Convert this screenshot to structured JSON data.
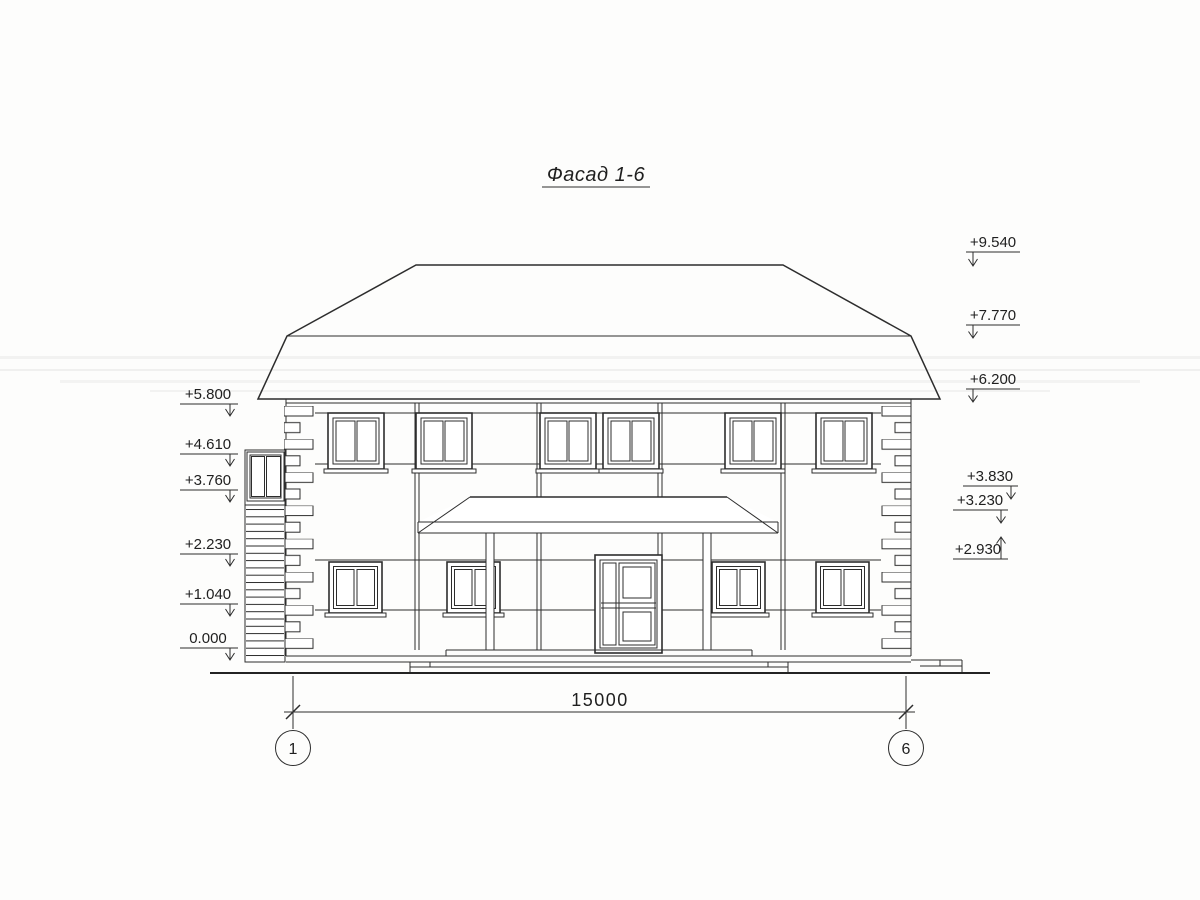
{
  "drawing": {
    "title": "Фасад 1-6",
    "dimension_label": "15000",
    "axis_left": "1",
    "axis_right": "6",
    "marks_left": [
      {
        "label": "+5.800"
      },
      {
        "label": "+4.610"
      },
      {
        "label": "+3.760"
      },
      {
        "label": "+2.230"
      },
      {
        "label": "+1.040"
      },
      {
        "label": "0.000"
      }
    ],
    "marks_right_upper": [
      {
        "label": "+9.540"
      },
      {
        "label": "+7.770"
      },
      {
        "label": "+6.200"
      }
    ],
    "marks_right_lower": [
      {
        "label": "+3.830"
      },
      {
        "label": "+3.230"
      },
      {
        "label": "+2.930"
      }
    ],
    "colors": {
      "ink": "#2d2d2d",
      "paper": "#fdfdfc"
    }
  }
}
